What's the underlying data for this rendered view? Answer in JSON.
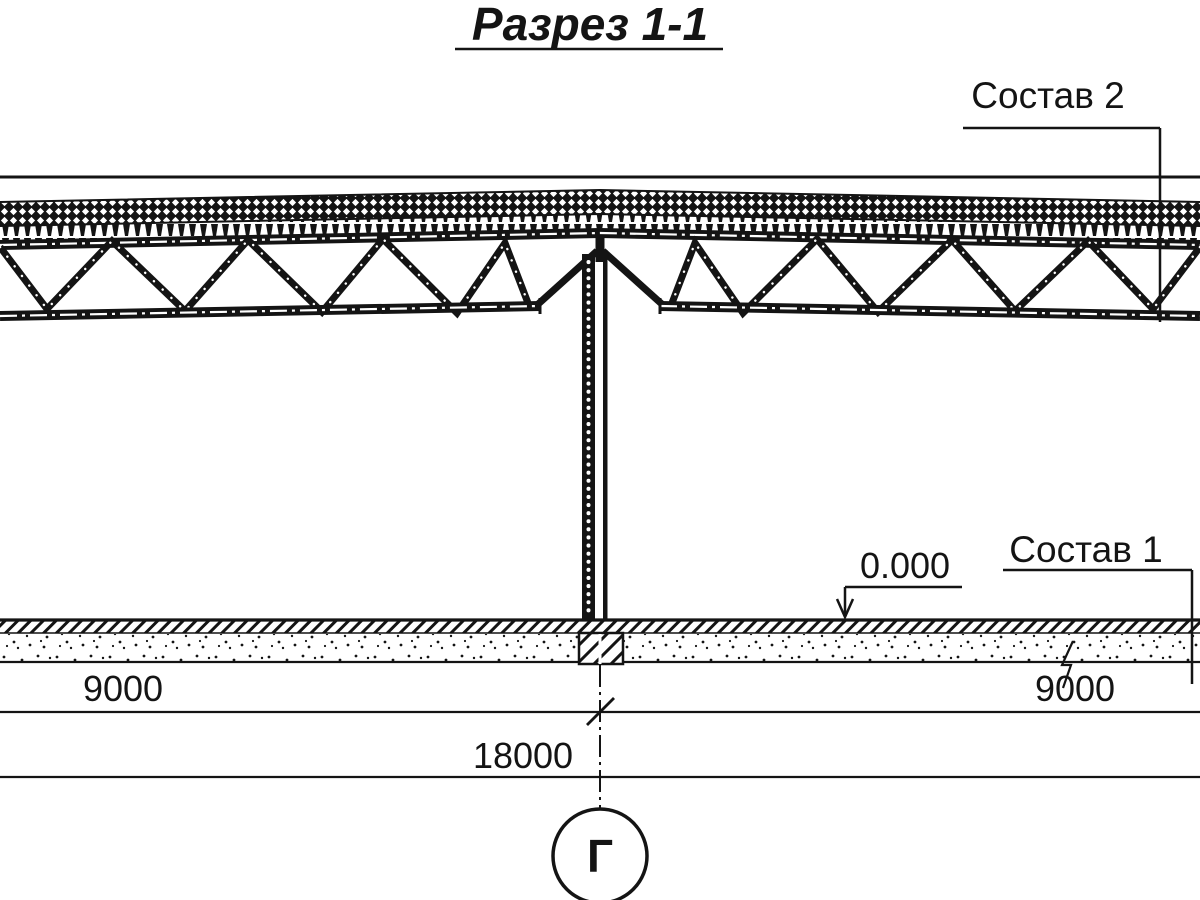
{
  "drawing": {
    "title": "Разрез 1-1",
    "callouts": {
      "roof_composition": "Состав 2",
      "floor_composition": "Состав 1",
      "elevation_mark": "0.000"
    },
    "dimensions": {
      "left_span": "9000",
      "right_span": "9000",
      "total_span": "18000"
    },
    "axis": {
      "label": "Г"
    },
    "colors": {
      "ink": "#141414",
      "background": "#ffffff"
    }
  }
}
